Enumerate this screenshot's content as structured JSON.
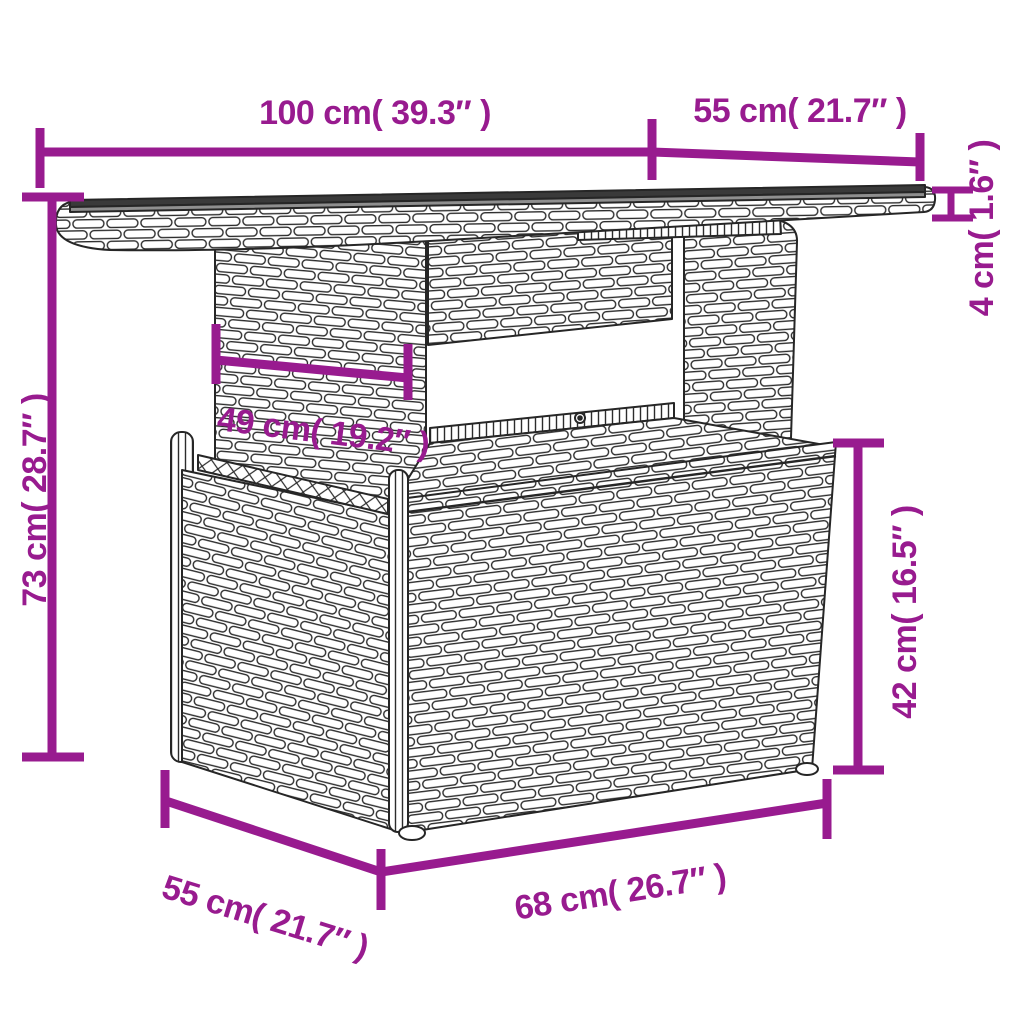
{
  "figure": {
    "kind": "product-dimension-diagram",
    "subject": "poly-rattan garden table line drawing",
    "accent_color": "#981b8f",
    "ink_color": "#262626",
    "background_color": "#ffffff"
  },
  "dimensions": {
    "top_width": {
      "label": "100 cm( 39.3″ )"
    },
    "top_depth": {
      "label": "55 cm( 21.7″ )"
    },
    "top_thickness": {
      "label": "4 cm( 1.6″ )"
    },
    "total_height": {
      "label": "73 cm( 28.7″ )"
    },
    "pedestal_width": {
      "label": "49 cm( 19.2″ )"
    },
    "base_height": {
      "label": "42 cm( 16.5″ )"
    },
    "base_depth": {
      "label": "55 cm( 21.7″ )"
    },
    "base_width": {
      "label": "68 cm( 26.7″ )"
    }
  }
}
